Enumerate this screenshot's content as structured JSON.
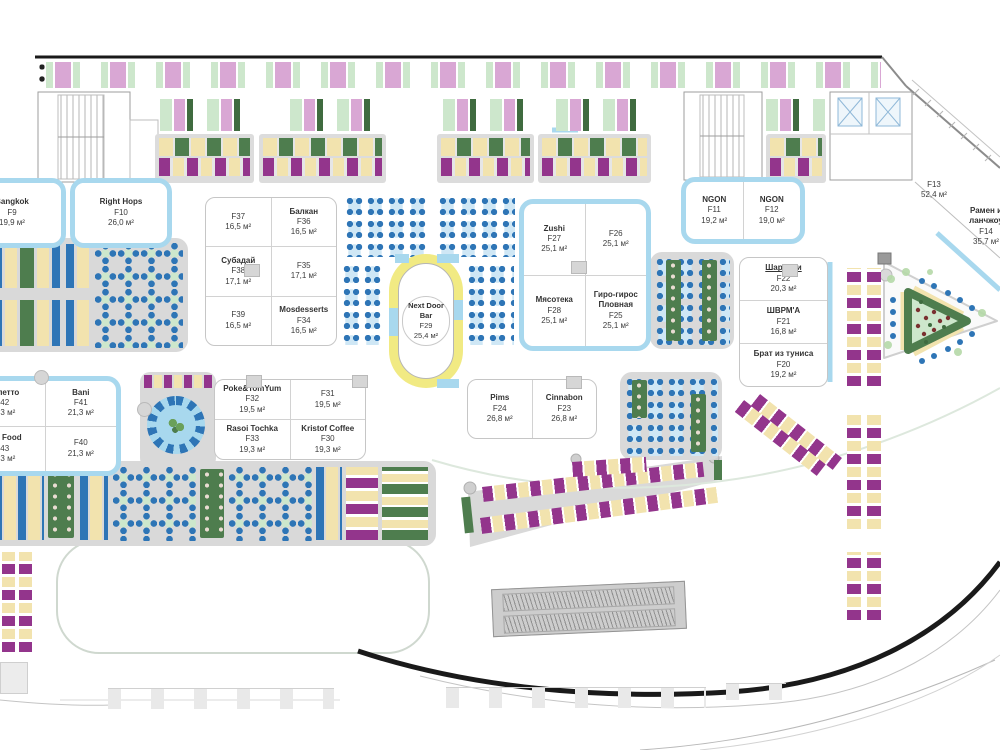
{
  "plan_title": "Food court floor plan",
  "units": {
    "f9": {
      "name": "Bangkok",
      "code": "F9",
      "area": "19,9 м²"
    },
    "f10": {
      "name": "Right Hops",
      "code": "F10",
      "area": "26,0 м²"
    },
    "f11": {
      "name": "NGON",
      "code": "F11",
      "area": "19,2 м²"
    },
    "f12": {
      "name": "NGON",
      "code": "F12",
      "area": "19,0 м²"
    },
    "f13": {
      "code": "F13",
      "area": "52,4 м²"
    },
    "f14": {
      "name": "Рамен и",
      "name2": "ланчжоу",
      "code": "F14",
      "area": "35,7 м²"
    },
    "f20": {
      "name": "Брат из туниса",
      "code": "F20",
      "area": "19,2 м²"
    },
    "f21": {
      "name": "ШВРМ'А",
      "code": "F21",
      "area": "16,8 м²"
    },
    "f22": {
      "name": "Шардени",
      "code": "F22",
      "area": "20,3 м²"
    },
    "f23": {
      "name": "Cinnabon",
      "code": "F23",
      "area": "26,8 м²"
    },
    "f24": {
      "name": "Pims",
      "code": "F24",
      "area": "26,8 м²"
    },
    "f25": {
      "name": "Гиро-гирос",
      "name2": "Пловная",
      "code": "F25",
      "area": "25,1 м²"
    },
    "f26": {
      "code": "F26",
      "area": "25,1 м²"
    },
    "f27": {
      "name": "Zushi",
      "code": "F27",
      "area": "25,1 м²"
    },
    "f28": {
      "name": "Мясотека",
      "code": "F28",
      "area": "25,1 м²"
    },
    "f29": {
      "name": "Next Door Bar",
      "code": "F29",
      "area": "25,4 м²"
    },
    "f30": {
      "name": "Kristof Coffee",
      "code": "F30",
      "area": "19,3 м²"
    },
    "f31": {
      "code": "F31",
      "area": "19,5 м²"
    },
    "f32": {
      "name": "Poke&TomYum",
      "code": "F32",
      "area": "19,5 м²"
    },
    "f33": {
      "name": "Rasoi Tochka",
      "code": "F33",
      "area": "19,3 м²"
    },
    "f34": {
      "name": "Mosdesserts",
      "code": "F34",
      "area": "16,5 м²"
    },
    "f35": {
      "code": "F35",
      "area": "17,1 м²"
    },
    "f36": {
      "name": "Балкан",
      "code": "F36",
      "area": "16,5 м²"
    },
    "f37": {
      "code": "F37",
      "area": "16,5 м²"
    },
    "f38": {
      "name": "Субадай",
      "code": "F38",
      "area": "17,1 м²"
    },
    "f39": {
      "code": "F39",
      "area": "16,5 м²"
    },
    "f40": {
      "code": "F40",
      "area": "21,3 м²"
    },
    "f41": {
      "name": "Bani",
      "code": "F41",
      "area": "21,3 м²"
    },
    "f42": {
      "name": "Омлетто",
      "code": "F42",
      "area": "21,3 м²"
    },
    "f43": {
      "name": "Asia Food",
      "code": "F43",
      "area": "21,3 м²"
    }
  },
  "colors": {
    "kiosk_border_blue": "#a8d8ee",
    "chair_blue": "#2e75b6",
    "table_dark_green": "#4e7d4e",
    "table_light_green": "#cde7cc",
    "table_yellow": "#f2e3ae",
    "table_purple": "#93358c",
    "table_pink": "#d9a7d4",
    "floor_gray": "#d9d9d9",
    "bar_ring_yellow": "#f1ea83",
    "outline_black": "#1a1a1a"
  }
}
